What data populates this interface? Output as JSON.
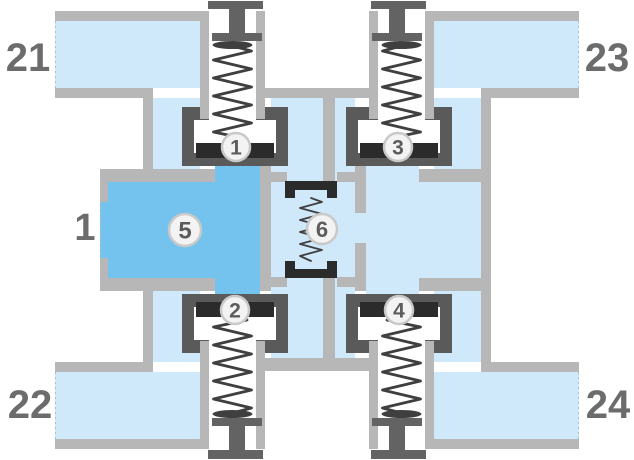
{
  "diagram": {
    "labels": {
      "port_21": "21",
      "port_22": "22",
      "port_23": "23",
      "port_24": "24",
      "port_1": "1",
      "valve_1": "1",
      "valve_2": "2",
      "valve_3": "3",
      "valve_4": "4",
      "chamber_5": "5",
      "element_6": "6"
    },
    "colors": {
      "background": "#ffffff",
      "wall_gray": "#b7b7b7",
      "fluid_light_blue": "#cfe8fa",
      "fluid_medium_blue": "#74c3ee",
      "housing_dark_gray": "#5a5a5a",
      "pocket_white": "#ffffff",
      "seat_black": "#2b2b2b",
      "spring_dark": "#3f3f3f",
      "screw_gray": "#636363",
      "label_gray": "#6c6c6c",
      "badge_fill": "#f3f3f3",
      "badge_border": "#c9c9c9",
      "badge_text": "#5c5c5c",
      "cut_edge": "#a9bfce"
    }
  }
}
